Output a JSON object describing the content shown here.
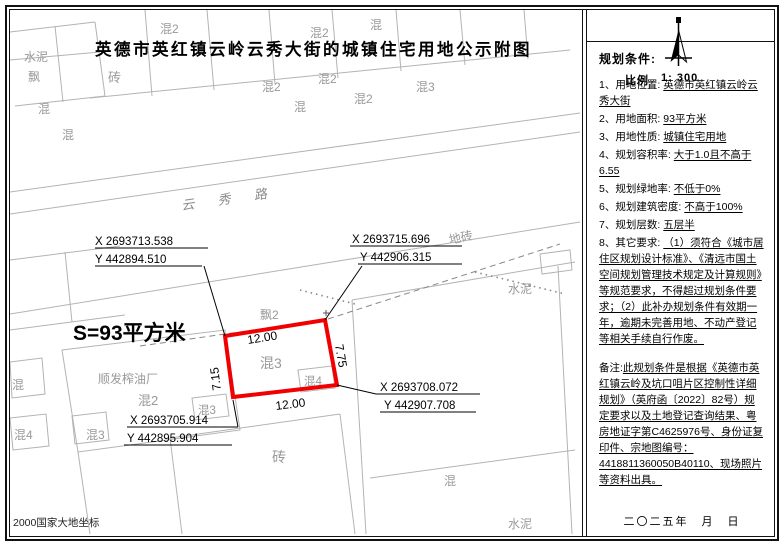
{
  "title": "英德市英红镇云岭云秀大街的城镇住宅用地公示附图",
  "scale": {
    "label": "比例",
    "value": "1: 300"
  },
  "map": {
    "road_label": "云 秀 路",
    "area_label": "S=93平方米",
    "datum_label": "2000国家大地坐标",
    "parcel": {
      "dim_top": "12.00",
      "dim_bottom": "12.00",
      "dim_left": "7.15",
      "dim_right": "7.75",
      "inner_label": "混3",
      "box_label_right": "混4",
      "box_label_left": "混3",
      "top_label": "飘2"
    },
    "coordinates": [
      {
        "x": "X 2693713.538",
        "y": "Y 442894.510"
      },
      {
        "x": "X 2693715.696",
        "y": "Y 442906.315"
      },
      {
        "x": "X 2693708.072",
        "y": "Y 442907.708"
      },
      {
        "x": "X 2693705.914",
        "y": "Y 442895.904"
      }
    ],
    "bg_labels": [
      "水泥",
      "飘",
      "砖",
      "混2",
      "混2",
      "混",
      "混2",
      "混2",
      "混3",
      "混2",
      "混",
      "混",
      "混",
      "地砖",
      "水泥",
      "顺发榨油厂",
      "混2",
      "混",
      "混4",
      "混3",
      "砖",
      "混",
      "水泥"
    ]
  },
  "panel": {
    "heading": "规划条件:",
    "items": [
      {
        "label": "1、用地位置:",
        "value": "英德市英红镇云岭云秀大街"
      },
      {
        "label": "2、用地面积:",
        "value": "93平方米"
      },
      {
        "label": "3、用地性质:",
        "value": "城镇住宅用地"
      },
      {
        "label": "4、规划容积率:",
        "value": "大于1.0且不高于6.55"
      },
      {
        "label": "5、规划绿地率:",
        "value": "不低于0%"
      },
      {
        "label": "6、规划建筑密度:",
        "value": "不高于100%"
      },
      {
        "label": "7、规划层数:",
        "value": "五层半"
      },
      {
        "label": "8、其它要求:",
        "value": "（1）须符合《城市居住区规划设计标准》、《清远市国土空间规划管理技术规定及计算规则》等规范要求，不得超过规划条件要求；（2）此补办规划条件有效期一年，逾期未完善用地、不动产登记等相关手续自行作废。"
      }
    ],
    "note": {
      "label": "备注:",
      "value": "此规划条件是根据《英德市英红镇云岭及坑口咀片区控制性详细规划》（英府函〔2022〕82号）规定要求以及土地登记查询结果、粤房地证字第C4625976号、身份证复印件、宗地图编号：4418811360050B40110、现场照片等资料出具。"
    },
    "date": "二〇二五年　月　日"
  },
  "colors": {
    "parcel_outline": "#f00000",
    "bg_line": "#b3b3b3",
    "text": "#000000"
  }
}
